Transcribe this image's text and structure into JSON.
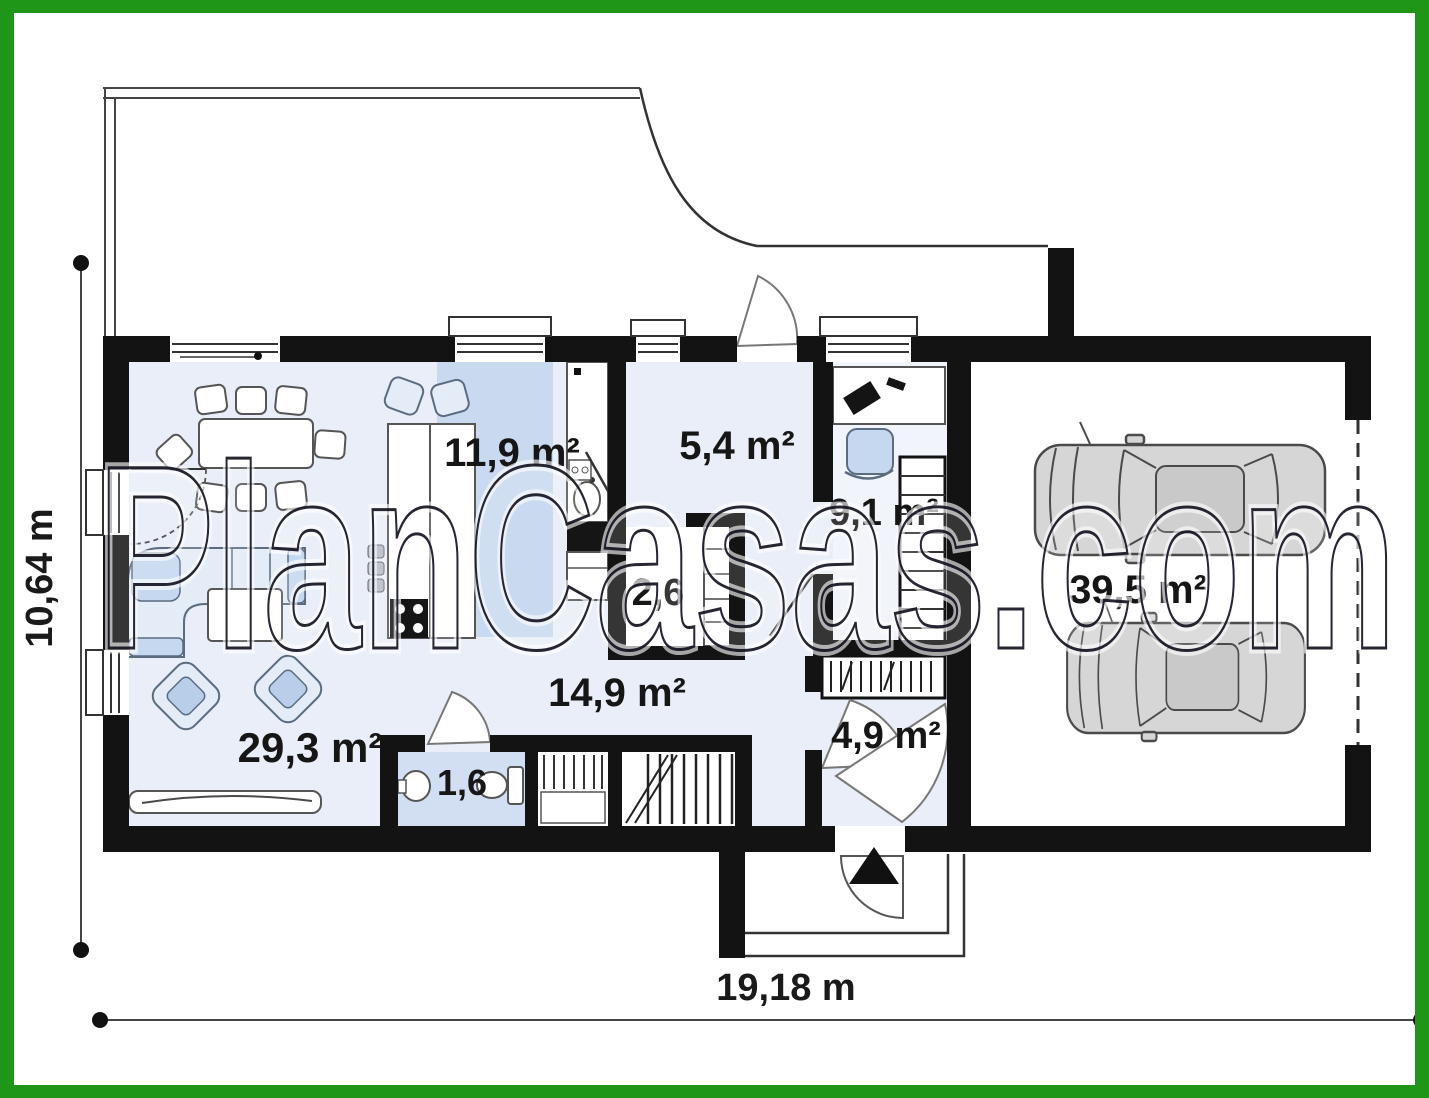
{
  "title": "house-ground-floor-plan",
  "watermark": "PlanCasas.com",
  "dimensions": {
    "width_total": "19,18 m",
    "depth_total": "10,64 m"
  },
  "rooms": {
    "living_room": "29,3 m²",
    "kitchen": "11,9 m²",
    "entry_hall": "5,4 m²",
    "pantry": "2,6",
    "hall": "14,9 m²",
    "office": "9,1 m²",
    "wc": "1,6",
    "vestibule": "4,9 m²",
    "garage": "39,5 m²"
  },
  "colors": {
    "frame_green": "#1f9617",
    "wall_black": "#131313",
    "floor_light_blue": "#e9eef8",
    "floor_accent_blue": "#c9d9ef",
    "wc_blue": "#d2dff2",
    "car_grey": "#d6d6d6"
  }
}
